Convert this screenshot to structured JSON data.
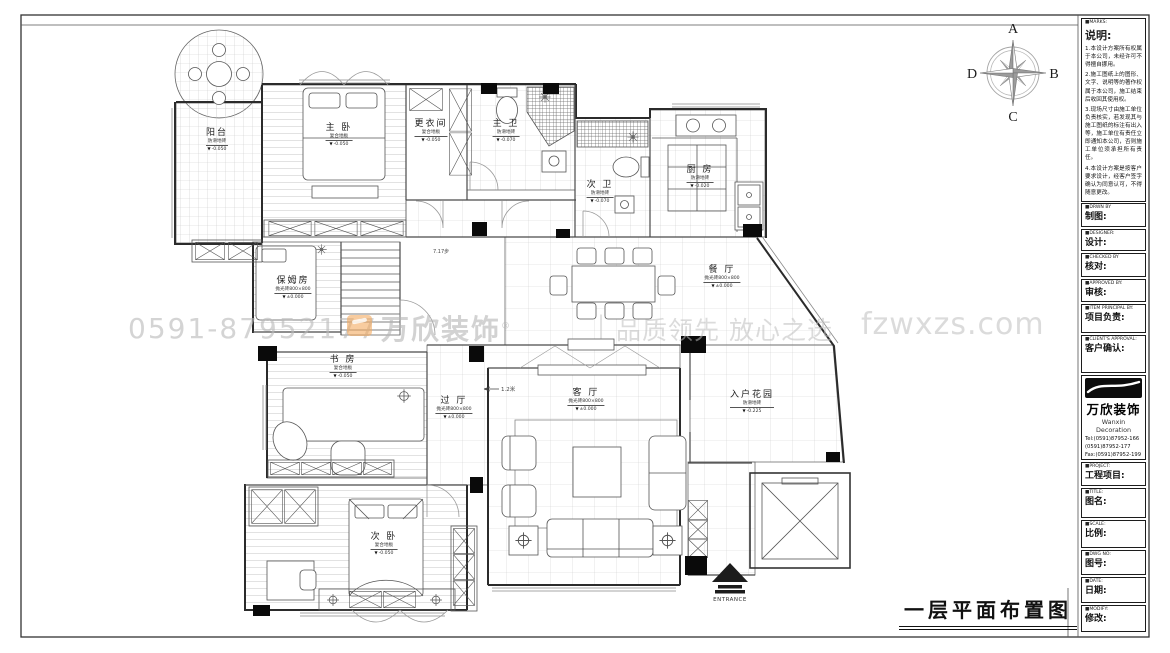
{
  "compass": {
    "n": "A",
    "e": "B",
    "s": "C",
    "w": "D"
  },
  "watermark": {
    "phone": "0591-87952177",
    "brand": "万欣装饰",
    "reg": "®",
    "sep": "|",
    "slogan": "品质领先 放心之选",
    "site": "fzwxzs.com"
  },
  "drawing_title": "一层平面布置图",
  "rooms": {
    "balcony": {
      "name": "阳台",
      "material": "防滑地砖",
      "elevation": "-0.050"
    },
    "master": {
      "name": "主 卧",
      "material": "复合地板",
      "elevation": "-0.050"
    },
    "dressing": {
      "name": "更衣间",
      "material": "复合地板",
      "elevation": "-0.050"
    },
    "mbath": {
      "name": "主 卫",
      "material": "防滑地砖",
      "elevation": "-0.070"
    },
    "sbath": {
      "name": "次 卫",
      "material": "防滑地砖",
      "elevation": "-0.070"
    },
    "kitchen": {
      "name": "厨 房",
      "material": "防滑地砖",
      "elevation": "-0.020"
    },
    "dining": {
      "name": "餐 厅",
      "material": "抛光砖800×800",
      "elevation": "±0.000"
    },
    "nanny": {
      "name": "保姆房",
      "material": "抛光砖800×800",
      "elevation": "±0.000"
    },
    "study": {
      "name": "书 房",
      "material": "复合地板",
      "elevation": "-0.050"
    },
    "hall": {
      "name": "过 厅",
      "material": "抛光砖800×800",
      "elevation": "±0.000"
    },
    "living": {
      "name": "客 厅",
      "material": "抛光砖800×800",
      "elevation": "±0.000"
    },
    "garden": {
      "name": "入户花园",
      "material": "防滑地砖",
      "elevation": "-0.225"
    },
    "bedroom2": {
      "name": "次 卧",
      "material": "复合地板",
      "elevation": "-0.050"
    }
  },
  "annotations": {
    "stairs": "7.17步",
    "dim": "1.2米",
    "entrance": "ENTRANCE"
  },
  "titleblock": {
    "marks": {
      "en": "■MARKS:",
      "zh": "说明:",
      "items": [
        "1.本设计方案所有权属于本公司，未经许可不得擅自挪用。",
        "2.施工图纸上的图形、文字、说明等的著作权属于本公司，施工结束后收回其使用权。",
        "3.现场尺寸由施工单位负责核实，若发现其与施工图纸的标注有出入等，施工单位有责任立即通知本公司，否则施工单位须承担所有责任。",
        "4.本设计方案是按客户要求设计，经客户签字确认为同意认可，不得随意更改。"
      ]
    },
    "fields": [
      {
        "en": "■DRWN BY",
        "zh": "制图:"
      },
      {
        "en": "■DESIGNER:",
        "zh": "设计:"
      },
      {
        "en": "■CHECKED BY",
        "zh": "核对:"
      },
      {
        "en": "■APPROVED BY:",
        "zh": "审核:"
      },
      {
        "en": "■ITEM PRINCIPAL BY:",
        "zh": "项目负责:"
      },
      {
        "en": "■CLIENT'S APPROVAL:",
        "zh": "客户确认:"
      }
    ],
    "company": {
      "brand": "万欣装饰",
      "brand_en": "Wanxin Decoration",
      "tel1": "Tel:(0591)87952-166",
      "tel2": "(0591)87952-177",
      "fax": "Fax:(0591)87952-199",
      "web": "Web:WWW.fzwxzs.com"
    },
    "fields2": [
      {
        "en": "■PROJECT:",
        "zh": "工程项目:"
      },
      {
        "en": "■TITLE:",
        "zh": "图名:"
      },
      {
        "en": "■SCALE:",
        "zh": "比例:"
      },
      {
        "en": "■DWG NO:",
        "zh": "图号:"
      },
      {
        "en": "■DATE:",
        "zh": "日期:"
      },
      {
        "en": "■MODIFY:",
        "zh": "修改:"
      }
    ]
  }
}
